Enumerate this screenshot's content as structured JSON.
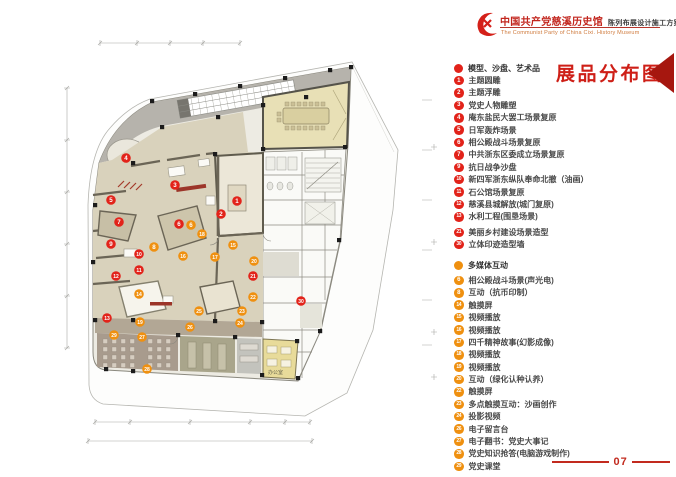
{
  "header": {
    "logo": "party-emblem-flame",
    "title_cn": "中国共产党慈溪历史馆",
    "title_scheme": "陈列布展设计施工方案",
    "title_en": "The Communist Party of China Cixi. History Museum"
  },
  "legend": {
    "title": "展品分布图",
    "categories": [
      {
        "label": "模型、沙盘、艺术品",
        "color": "#e2231a",
        "items": [
          {
            "num": 1,
            "label": "主题圆雕"
          },
          {
            "num": 2,
            "label": "主题浮雕"
          },
          {
            "num": 3,
            "label": "党史人物雕塑"
          },
          {
            "num": 4,
            "label": "庵东盐民大罢工场景复原"
          },
          {
            "num": 5,
            "label": "日军轰炸场景"
          },
          {
            "num": 6,
            "label": "相公殿战斗场景复原"
          },
          {
            "num": 7,
            "label": "中共浙东区委成立场景复原"
          },
          {
            "num": 9,
            "label": "抗日战争沙盘"
          },
          {
            "num": 10,
            "label": "新四军浙东纵队奉命北撤（油画）"
          },
          {
            "num": 11,
            "label": "石公馆场景复原"
          },
          {
            "num": 12,
            "label": "慈溪县城解放(城门复原)"
          },
          {
            "num": 13,
            "label": "水利工程(围垦场景)"
          },
          {
            "num": 21,
            "label": "美丽乡村建设场景造型",
            "gap": true
          },
          {
            "num": 30,
            "label": "立体印迹造型墙"
          }
        ]
      },
      {
        "label": "多媒体互动",
        "color": "#ef9010",
        "items": [
          {
            "num": 6,
            "label": "相公殿战斗场景(声光电)",
            "gap": true
          },
          {
            "num": 8,
            "label": "互动（抗币印制）"
          },
          {
            "num": 14,
            "label": "触摸屏"
          },
          {
            "num": 15,
            "label": "视频播放"
          },
          {
            "num": 16,
            "label": "视频播放"
          },
          {
            "num": 17,
            "label": "四千精神故事(幻影成像)"
          },
          {
            "num": 18,
            "label": "视频播放"
          },
          {
            "num": 19,
            "label": "视频播放"
          },
          {
            "num": 20,
            "label": "互动（绿化认种认养）"
          },
          {
            "num": 22,
            "label": "触摸屏"
          },
          {
            "num": 23,
            "label": "多点触摸互动：沙画创作"
          },
          {
            "num": 24,
            "label": "投影视频"
          },
          {
            "num": 26,
            "label": "电子留言台"
          },
          {
            "num": 27,
            "label": "电子翻书：党史大事记"
          },
          {
            "num": 28,
            "label": "党史知识抢答(电脑游戏制作)"
          },
          {
            "num": 29,
            "label": "党史课堂"
          }
        ]
      }
    ]
  },
  "page": {
    "number": "07"
  },
  "plan": {
    "office_label": "办公室",
    "watermark": "海笛设计",
    "colors": {
      "red": "#e2231a",
      "orange": "#ef9010"
    },
    "markers": [
      {
        "n": 1,
        "c": "r",
        "x": 237,
        "y": 201
      },
      {
        "n": 2,
        "c": "r",
        "x": 221,
        "y": 214
      },
      {
        "n": 3,
        "c": "r",
        "x": 175,
        "y": 185
      },
      {
        "n": 4,
        "c": "r",
        "x": 126,
        "y": 158
      },
      {
        "n": 5,
        "c": "r",
        "x": 111,
        "y": 200
      },
      {
        "n": 6,
        "c": "r",
        "x": 179,
        "y": 224
      },
      {
        "n": 7,
        "c": "r",
        "x": 119,
        "y": 222
      },
      {
        "n": 9,
        "c": "r",
        "x": 111,
        "y": 244
      },
      {
        "n": 10,
        "c": "r",
        "x": 139,
        "y": 254
      },
      {
        "n": 11,
        "c": "r",
        "x": 139,
        "y": 270
      },
      {
        "n": 12,
        "c": "r",
        "x": 116,
        "y": 276
      },
      {
        "n": 13,
        "c": "r",
        "x": 107,
        "y": 318
      },
      {
        "n": 21,
        "c": "r",
        "x": 253,
        "y": 276
      },
      {
        "n": 30,
        "c": "r",
        "x": 301,
        "y": 301
      },
      {
        "n": 6,
        "c": "o",
        "x": 191,
        "y": 225
      },
      {
        "n": 8,
        "c": "o",
        "x": 154,
        "y": 247
      },
      {
        "n": 14,
        "c": "o",
        "x": 139,
        "y": 294
      },
      {
        "n": 15,
        "c": "o",
        "x": 233,
        "y": 245
      },
      {
        "n": 16,
        "c": "o",
        "x": 183,
        "y": 256
      },
      {
        "n": 17,
        "c": "o",
        "x": 215,
        "y": 257
      },
      {
        "n": 18,
        "c": "o",
        "x": 202,
        "y": 234
      },
      {
        "n": 19,
        "c": "o",
        "x": 140,
        "y": 322
      },
      {
        "n": 20,
        "c": "o",
        "x": 254,
        "y": 261
      },
      {
        "n": 22,
        "c": "o",
        "x": 253,
        "y": 297
      },
      {
        "n": 23,
        "c": "o",
        "x": 242,
        "y": 311
      },
      {
        "n": 24,
        "c": "o",
        "x": 240,
        "y": 323
      },
      {
        "n": 25,
        "c": "o",
        "x": 199,
        "y": 311
      },
      {
        "n": 26,
        "c": "o",
        "x": 190,
        "y": 327
      },
      {
        "n": 27,
        "c": "o",
        "x": 142,
        "y": 337
      },
      {
        "n": 28,
        "c": "o",
        "x": 147,
        "y": 369
      },
      {
        "n": 29,
        "c": "o",
        "x": 114,
        "y": 335
      }
    ]
  }
}
